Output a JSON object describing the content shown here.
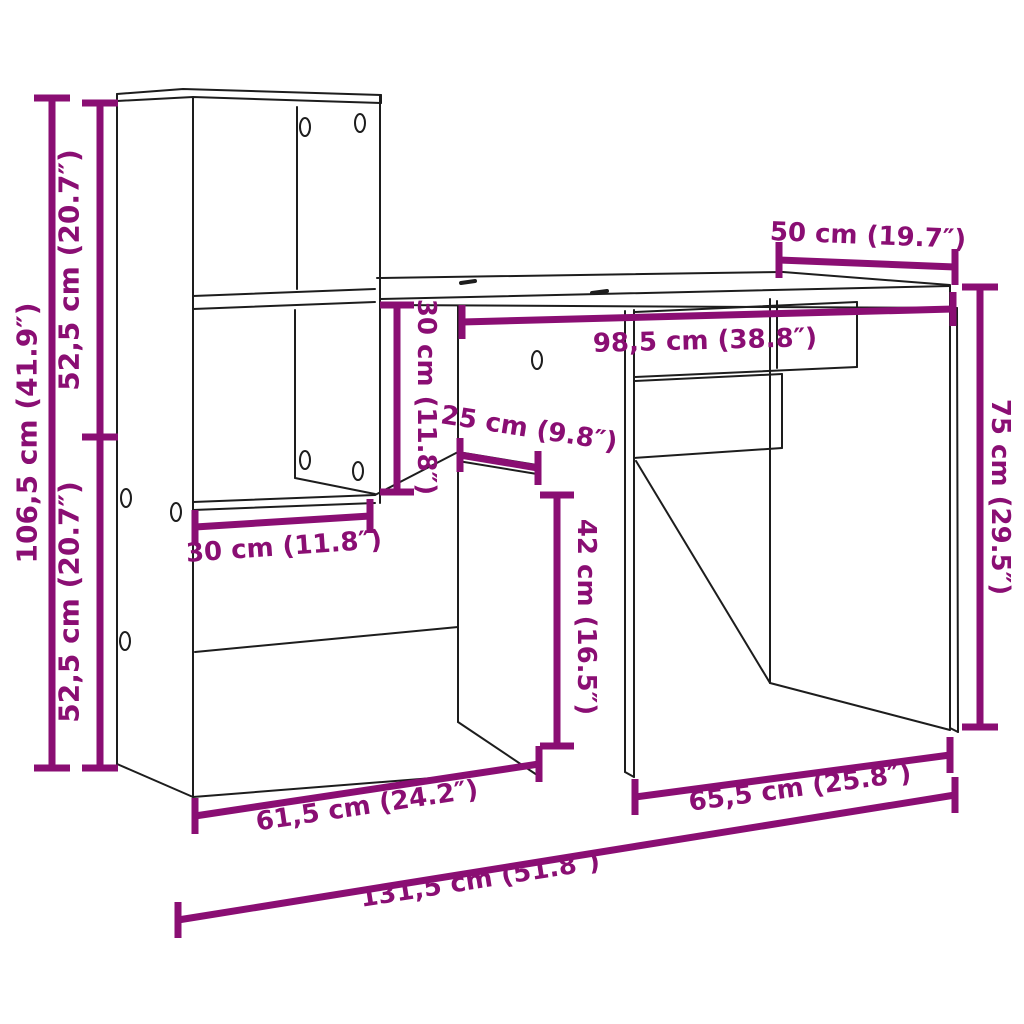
{
  "diagram": {
    "title": "Desk with shelving unit — dimension diagram",
    "background_color": "#ffffff",
    "furniture_line_color": "#1d1d1d",
    "dimension_color": "#8A0E73",
    "unit_primary": "cm",
    "unit_secondary": "inches",
    "dims": [
      {
        "id": "overall-height",
        "label": "106,5 cm (41.9″)",
        "value_cm": "106,5",
        "value_in": "41.9",
        "orientation": "vertical"
      },
      {
        "id": "upper-half-height",
        "label": "52,5 cm (20.7″)",
        "value_cm": "52,5",
        "value_in": "20.7",
        "orientation": "vertical"
      },
      {
        "id": "lower-half-height",
        "label": "52,5 cm (20.7″)",
        "value_cm": "52,5",
        "value_in": "20.7",
        "orientation": "vertical"
      },
      {
        "id": "desktop-depth",
        "label": "50 cm (19.7″)",
        "value_cm": "50",
        "value_in": "19.7",
        "orientation": "horizontal"
      },
      {
        "id": "desktop-width",
        "label": "98,5 cm (38.8″)",
        "value_cm": "98,5",
        "value_in": "38.8",
        "orientation": "horizontal"
      },
      {
        "id": "hutch-clearance",
        "label": "30 cm (11.8″)",
        "value_cm": "30",
        "value_in": "11.8",
        "orientation": "vertical"
      },
      {
        "id": "side-shelf-depth",
        "label": "25 cm (9.8″)",
        "value_cm": "25",
        "value_in": "9.8",
        "orientation": "horizontal"
      },
      {
        "id": "shelf-depth",
        "label": "30 cm (11.8″)",
        "value_cm": "30",
        "value_in": "11.8",
        "orientation": "horizontal"
      },
      {
        "id": "floor-clearance",
        "label": "42 cm (16.5″)",
        "value_cm": "42",
        "value_in": "16.5",
        "orientation": "vertical"
      },
      {
        "id": "desk-height",
        "label": "75 cm (29.5″)",
        "value_cm": "75",
        "value_in": "29.5",
        "orientation": "vertical"
      },
      {
        "id": "cabinet-width",
        "label": "61,5 cm (24.2″)",
        "value_cm": "61,5",
        "value_in": "24.2",
        "orientation": "horizontal"
      },
      {
        "id": "desk-section-width",
        "label": "65,5 cm (25.8″)",
        "value_cm": "65,5",
        "value_in": "25.8",
        "orientation": "horizontal"
      },
      {
        "id": "overall-width",
        "label": "131,5 cm (51.8″)",
        "value_cm": "131,5",
        "value_in": "51.8",
        "orientation": "horizontal"
      }
    ]
  }
}
